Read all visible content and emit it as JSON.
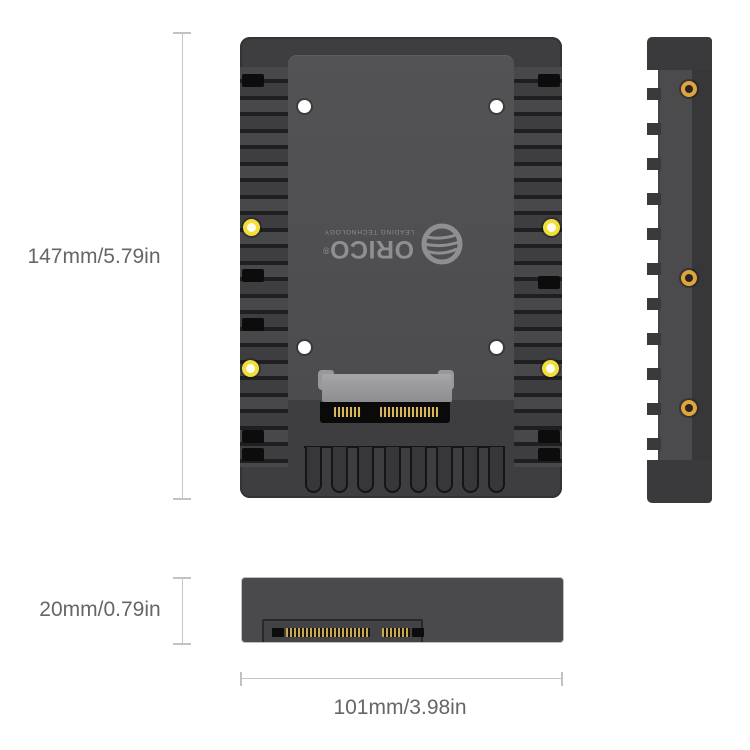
{
  "title": "ORICO 2.5 inch to 3.5 inch hard drive adapter dimension diagram",
  "dimensions": {
    "height": {
      "label": "147mm/5.79in"
    },
    "thickness": {
      "label": "20mm/0.79in"
    },
    "width": {
      "label": "101mm/3.98in"
    }
  },
  "logo": {
    "brand": "ORICO",
    "registered_mark": "®",
    "tagline": "LEADING TECHNOLOGY"
  },
  "icons": {
    "globe": "orico-globe-icon",
    "front_drive_holes": "white-screw-hole-icon",
    "front_mount_screws": "gold-screw-icon",
    "side_mount_screws": "gold-screw-icon",
    "connector_front": "sata-connector",
    "connector_bottom": "sata-connector-edge"
  },
  "colors": {
    "background": "#ffffff",
    "body_dark": "#3a3a3c",
    "body_fin": "#48484b",
    "tray_plate": "#505052",
    "slot_black": "#0c0c0c",
    "screw_gold_front": "#f2de39",
    "screw_gold_side": "#dfa43c",
    "screw_white": "#ffffff",
    "sata_bracket_gray": "#98989a",
    "sata_pin_gold": "#d9b75e",
    "dimension_line": "#c6c6c6",
    "dimension_text": "#666666",
    "logo_gray": "#8f8f91"
  }
}
